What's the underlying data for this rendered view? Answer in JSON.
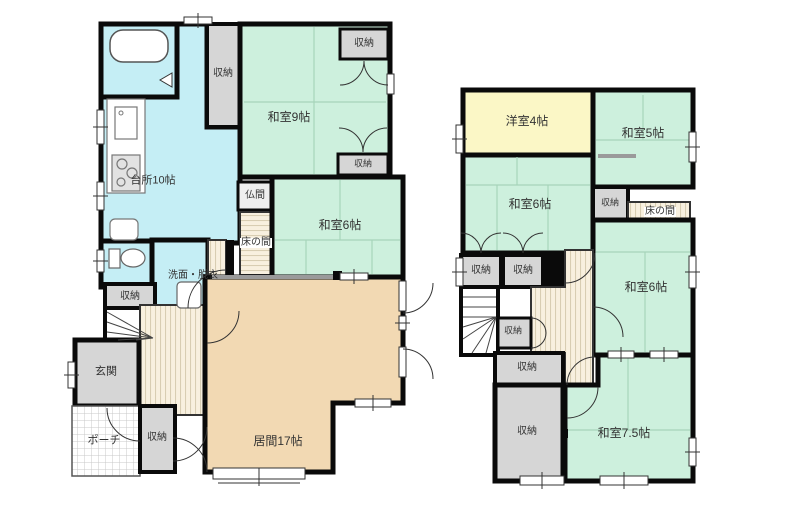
{
  "title": "house-floorplan",
  "floor1": {
    "rooms": {
      "kitchen": "台所10帖",
      "japanese9": "和室9帖",
      "japanese6": "和室6帖",
      "butsuma": "仏間",
      "tokonoma": "床の間",
      "washroom": "洗面・脱衣",
      "entrance": "玄関",
      "porch": "ポーチ",
      "living": "居間17帖",
      "storage": "収納"
    }
  },
  "floor2": {
    "rooms": {
      "western4": "洋室4帖",
      "japanese5": "和室5帖",
      "japanese6": "和室6帖",
      "japanese75": "和室7.5帖",
      "tokonoma": "床の間",
      "storage": "収納"
    }
  },
  "palette": {
    "wall": "#0a0a0a",
    "tatami_green": "#cdf0dd",
    "water_cyan": "#c5eef5",
    "living_tan": "#f2d9b3",
    "western_yellow": "#fbf7c6",
    "storage_gray": "#d6d6d6",
    "wood_beige": "#f8f0df",
    "label_text": "#333333"
  }
}
